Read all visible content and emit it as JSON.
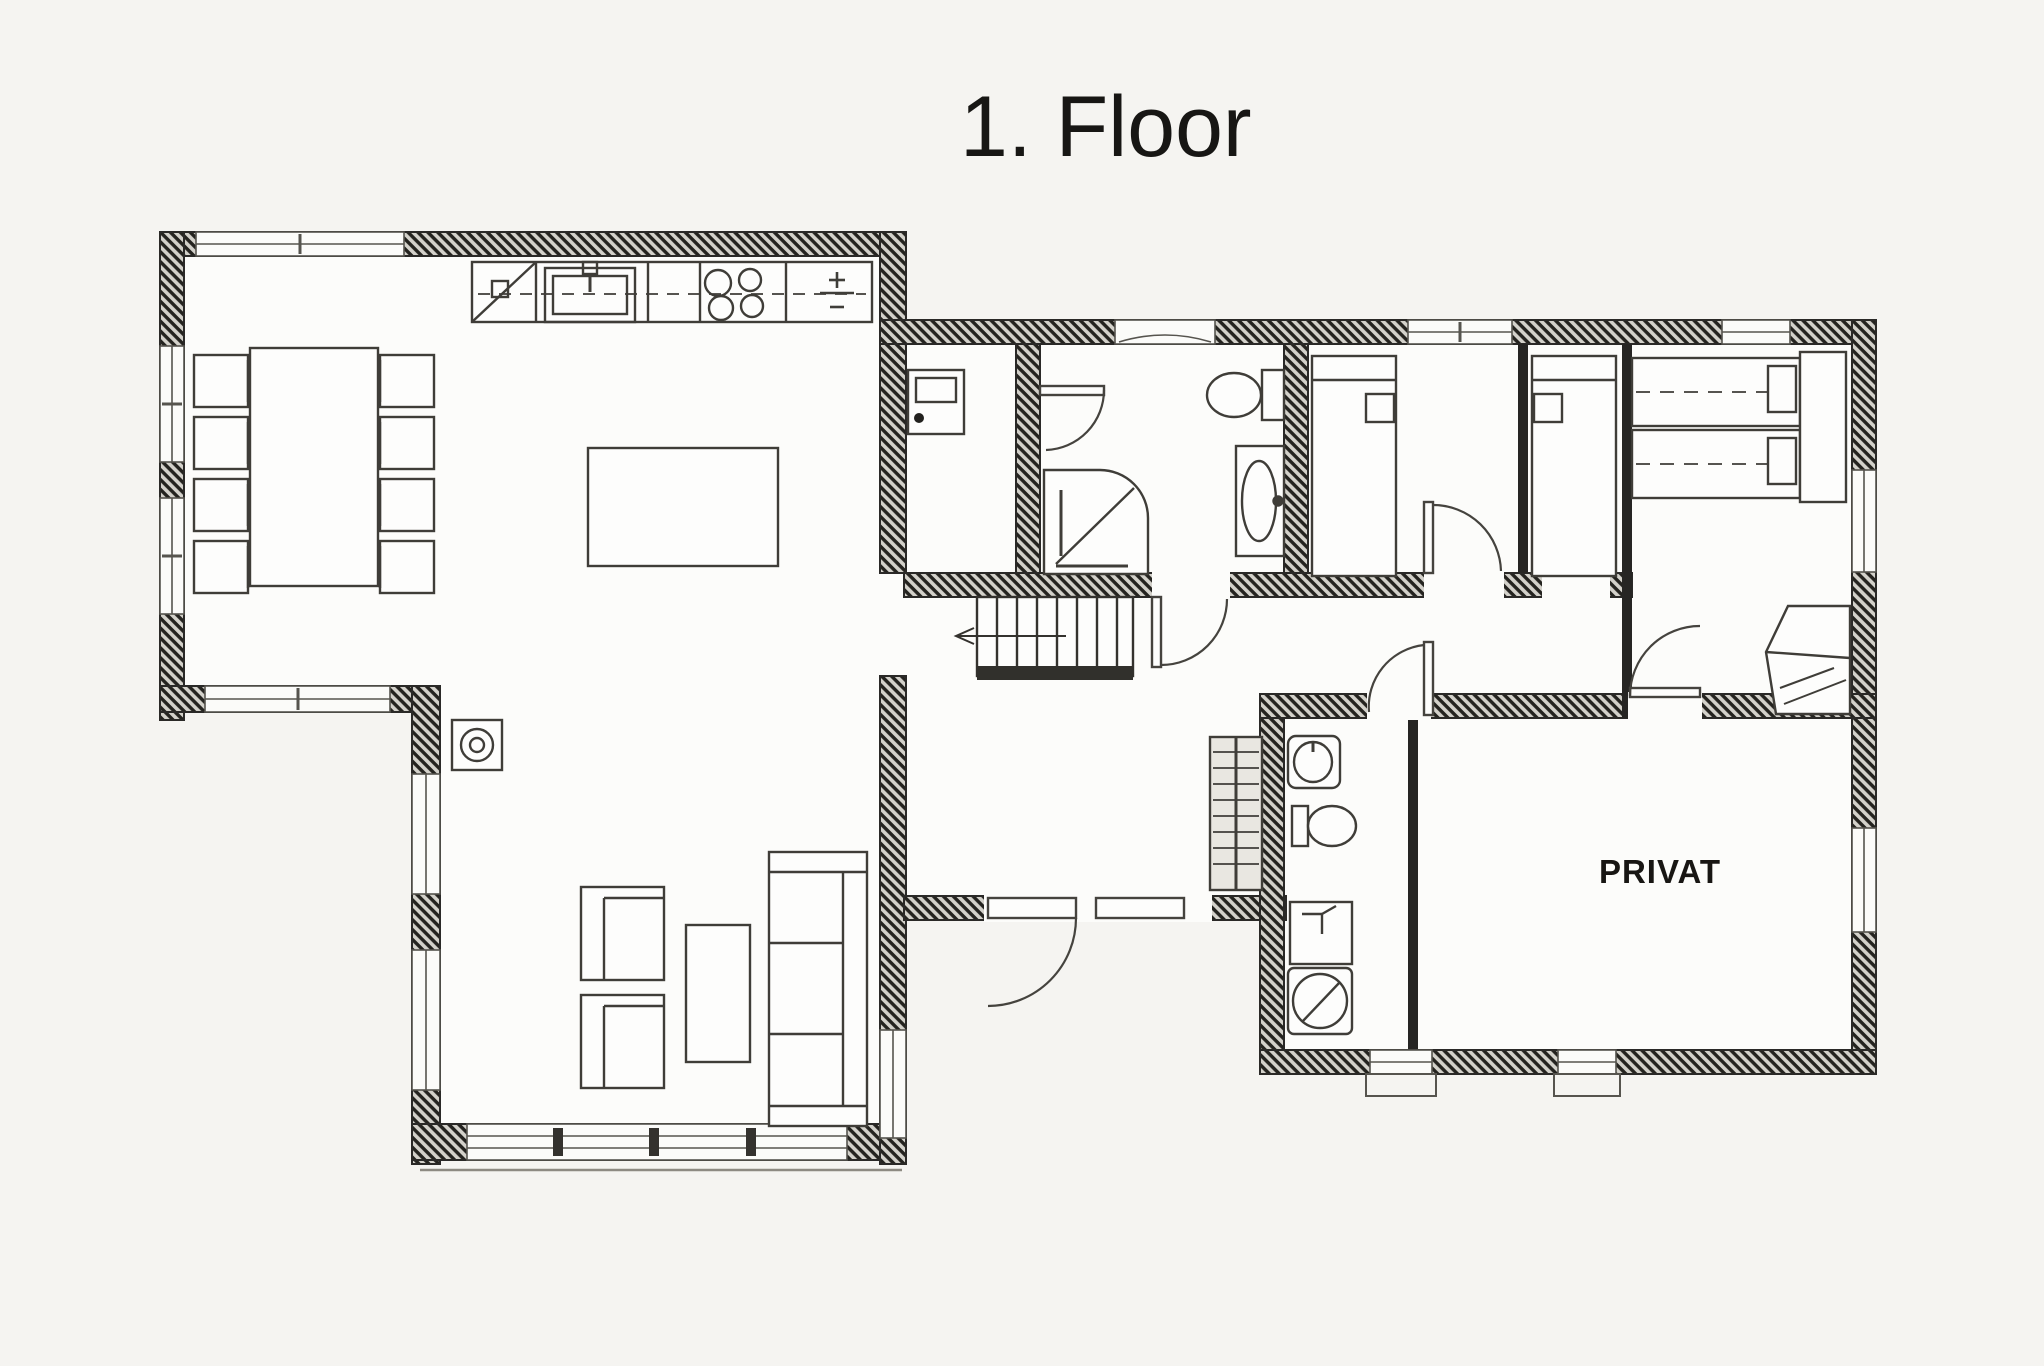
{
  "title": "1. Floor",
  "labels": {
    "private": "PRIVAT"
  },
  "colors": {
    "paper": "#f5f4f1",
    "room": "#fcfcfa",
    "ink": "#2e2c29",
    "wall_dark": "#21201e",
    "wall_light": "#d3d1ca"
  },
  "icons": [
    "kitchen-sink-icon",
    "cooktop-icon",
    "appliance-plusminus-icon",
    "dining-table-icon",
    "dining-chair-icon",
    "kitchen-island-icon",
    "wood-stove-icon",
    "armchair-icon",
    "coffee-table-icon",
    "sofa-icon",
    "stairs-icon",
    "door-swing-icon",
    "entrance-double-door-icon",
    "entry-cabinet-icon",
    "shower-icon",
    "toilet-icon",
    "washbasin-icon",
    "single-bed-icon",
    "double-bed-icon",
    "wardrobe-icon",
    "coat-closet-icon",
    "water-heater-icon",
    "washing-machine-icon",
    "window-icon",
    "porch-step-icon"
  ]
}
